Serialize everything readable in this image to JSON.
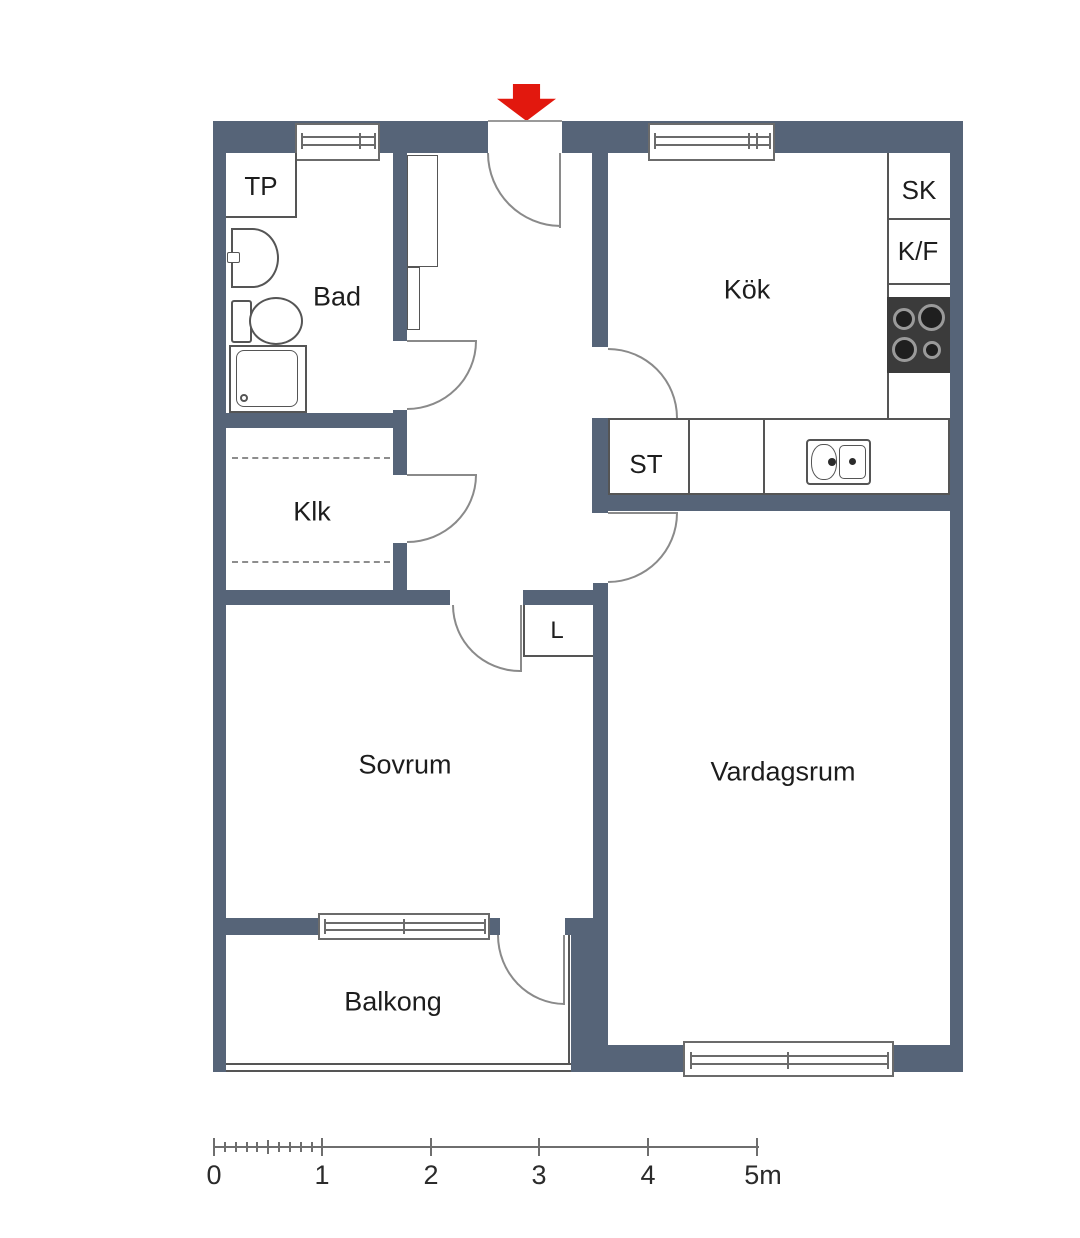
{
  "rooms": {
    "tp": "TP",
    "bad": "Bad",
    "klk": "Klk",
    "kok": "Kök",
    "sk": "SK",
    "kf": "K/F",
    "st": "ST",
    "l": "L",
    "sovrum": "Sovrum",
    "vardagsrum": "Vardagsrum",
    "balkong": "Balkong"
  },
  "scale_bar": {
    "labels": [
      "0",
      "1",
      "2",
      "3",
      "4",
      "5m"
    ]
  },
  "colors": {
    "wall": "#566478",
    "thin_line": "#555555",
    "door_arc": "#8a8a8a",
    "entrance_arrow": "#e2180e",
    "stove": "#3b3b3b"
  }
}
